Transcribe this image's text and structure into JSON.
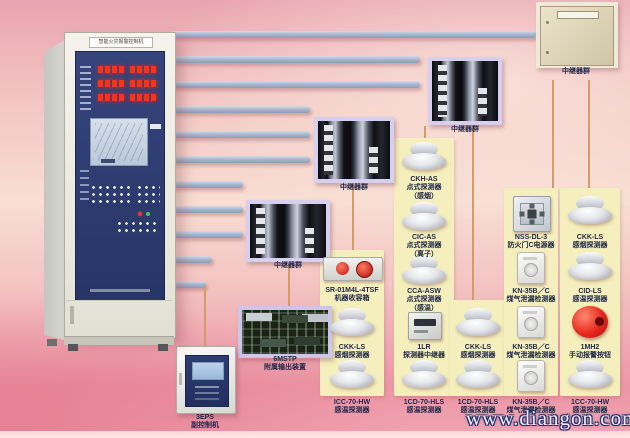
{
  "cabinet": {
    "title": "智能火灾报警控制机"
  },
  "labels": {
    "repeater_group": "中继器群"
  },
  "watermark": "www.diangon.com",
  "devices": {
    "ckh_as": {
      "model": "CKH-AS",
      "line2": "点式探测器",
      "line3": "（感烟）"
    },
    "cic_as": {
      "model": "CIC-AS",
      "line2": "点式探测器",
      "line3": "（离子）"
    },
    "cca_asw": {
      "model": "CCA-ASW",
      "line2": "点式探测器",
      "line3": "（感温）"
    },
    "sr": {
      "model": "SR-01M4L-4TSF",
      "line2": "机器收容箱"
    },
    "mstp": {
      "model": "6MSTP",
      "line2": "附属输出装置"
    },
    "eps": {
      "model": "3EPS",
      "line2": "副控制机"
    },
    "ckk_a": {
      "model": "CKK-LS",
      "line2": "感烟探测器"
    },
    "lr": {
      "model": "1LR",
      "line2": "探测器中继器"
    },
    "ckk_c": {
      "model": "CKK-LS",
      "line2": "感烟探测器"
    },
    "nss": {
      "model": "NSS-DL-3",
      "line2": "防火门C电源器"
    },
    "ckk_e": {
      "model": "CKK-LS",
      "line2": "感烟探测器"
    },
    "kn_d2": {
      "model": "KN-35B／C",
      "line2": "煤气泄漏检测器"
    },
    "cid": {
      "model": "CID-LS",
      "line2": "感温探测器"
    },
    "kn_d3": {
      "model": "KN-35B／C",
      "line2": "煤气泄漏检测器"
    },
    "mh2": {
      "model": "1MH2",
      "line2": "手动报警按钮"
    },
    "icc": {
      "model": "ICC-70-HW",
      "line2": "感温探测器"
    },
    "cd_b": {
      "model": "1CD-70-HLS",
      "line2": "感温探测器"
    },
    "cd_c": {
      "model": "1CD-70-HLS",
      "line2": "感温探测器"
    },
    "kn_d4": {
      "model": "KN-35B／C",
      "line2": "煤气泄漏检测器"
    },
    "cc": {
      "model": "1CC-70-HW",
      "line2": "感温探测器"
    }
  },
  "colors": {
    "background_pink": "#f2c4c1",
    "bus_bar": "#9fb0c8",
    "wire": "#d59a6a",
    "device_card": "#f4efbc",
    "panel_navy": "#2e3c72",
    "led_red": "#ff3114",
    "alarm_red": "#c01612"
  }
}
